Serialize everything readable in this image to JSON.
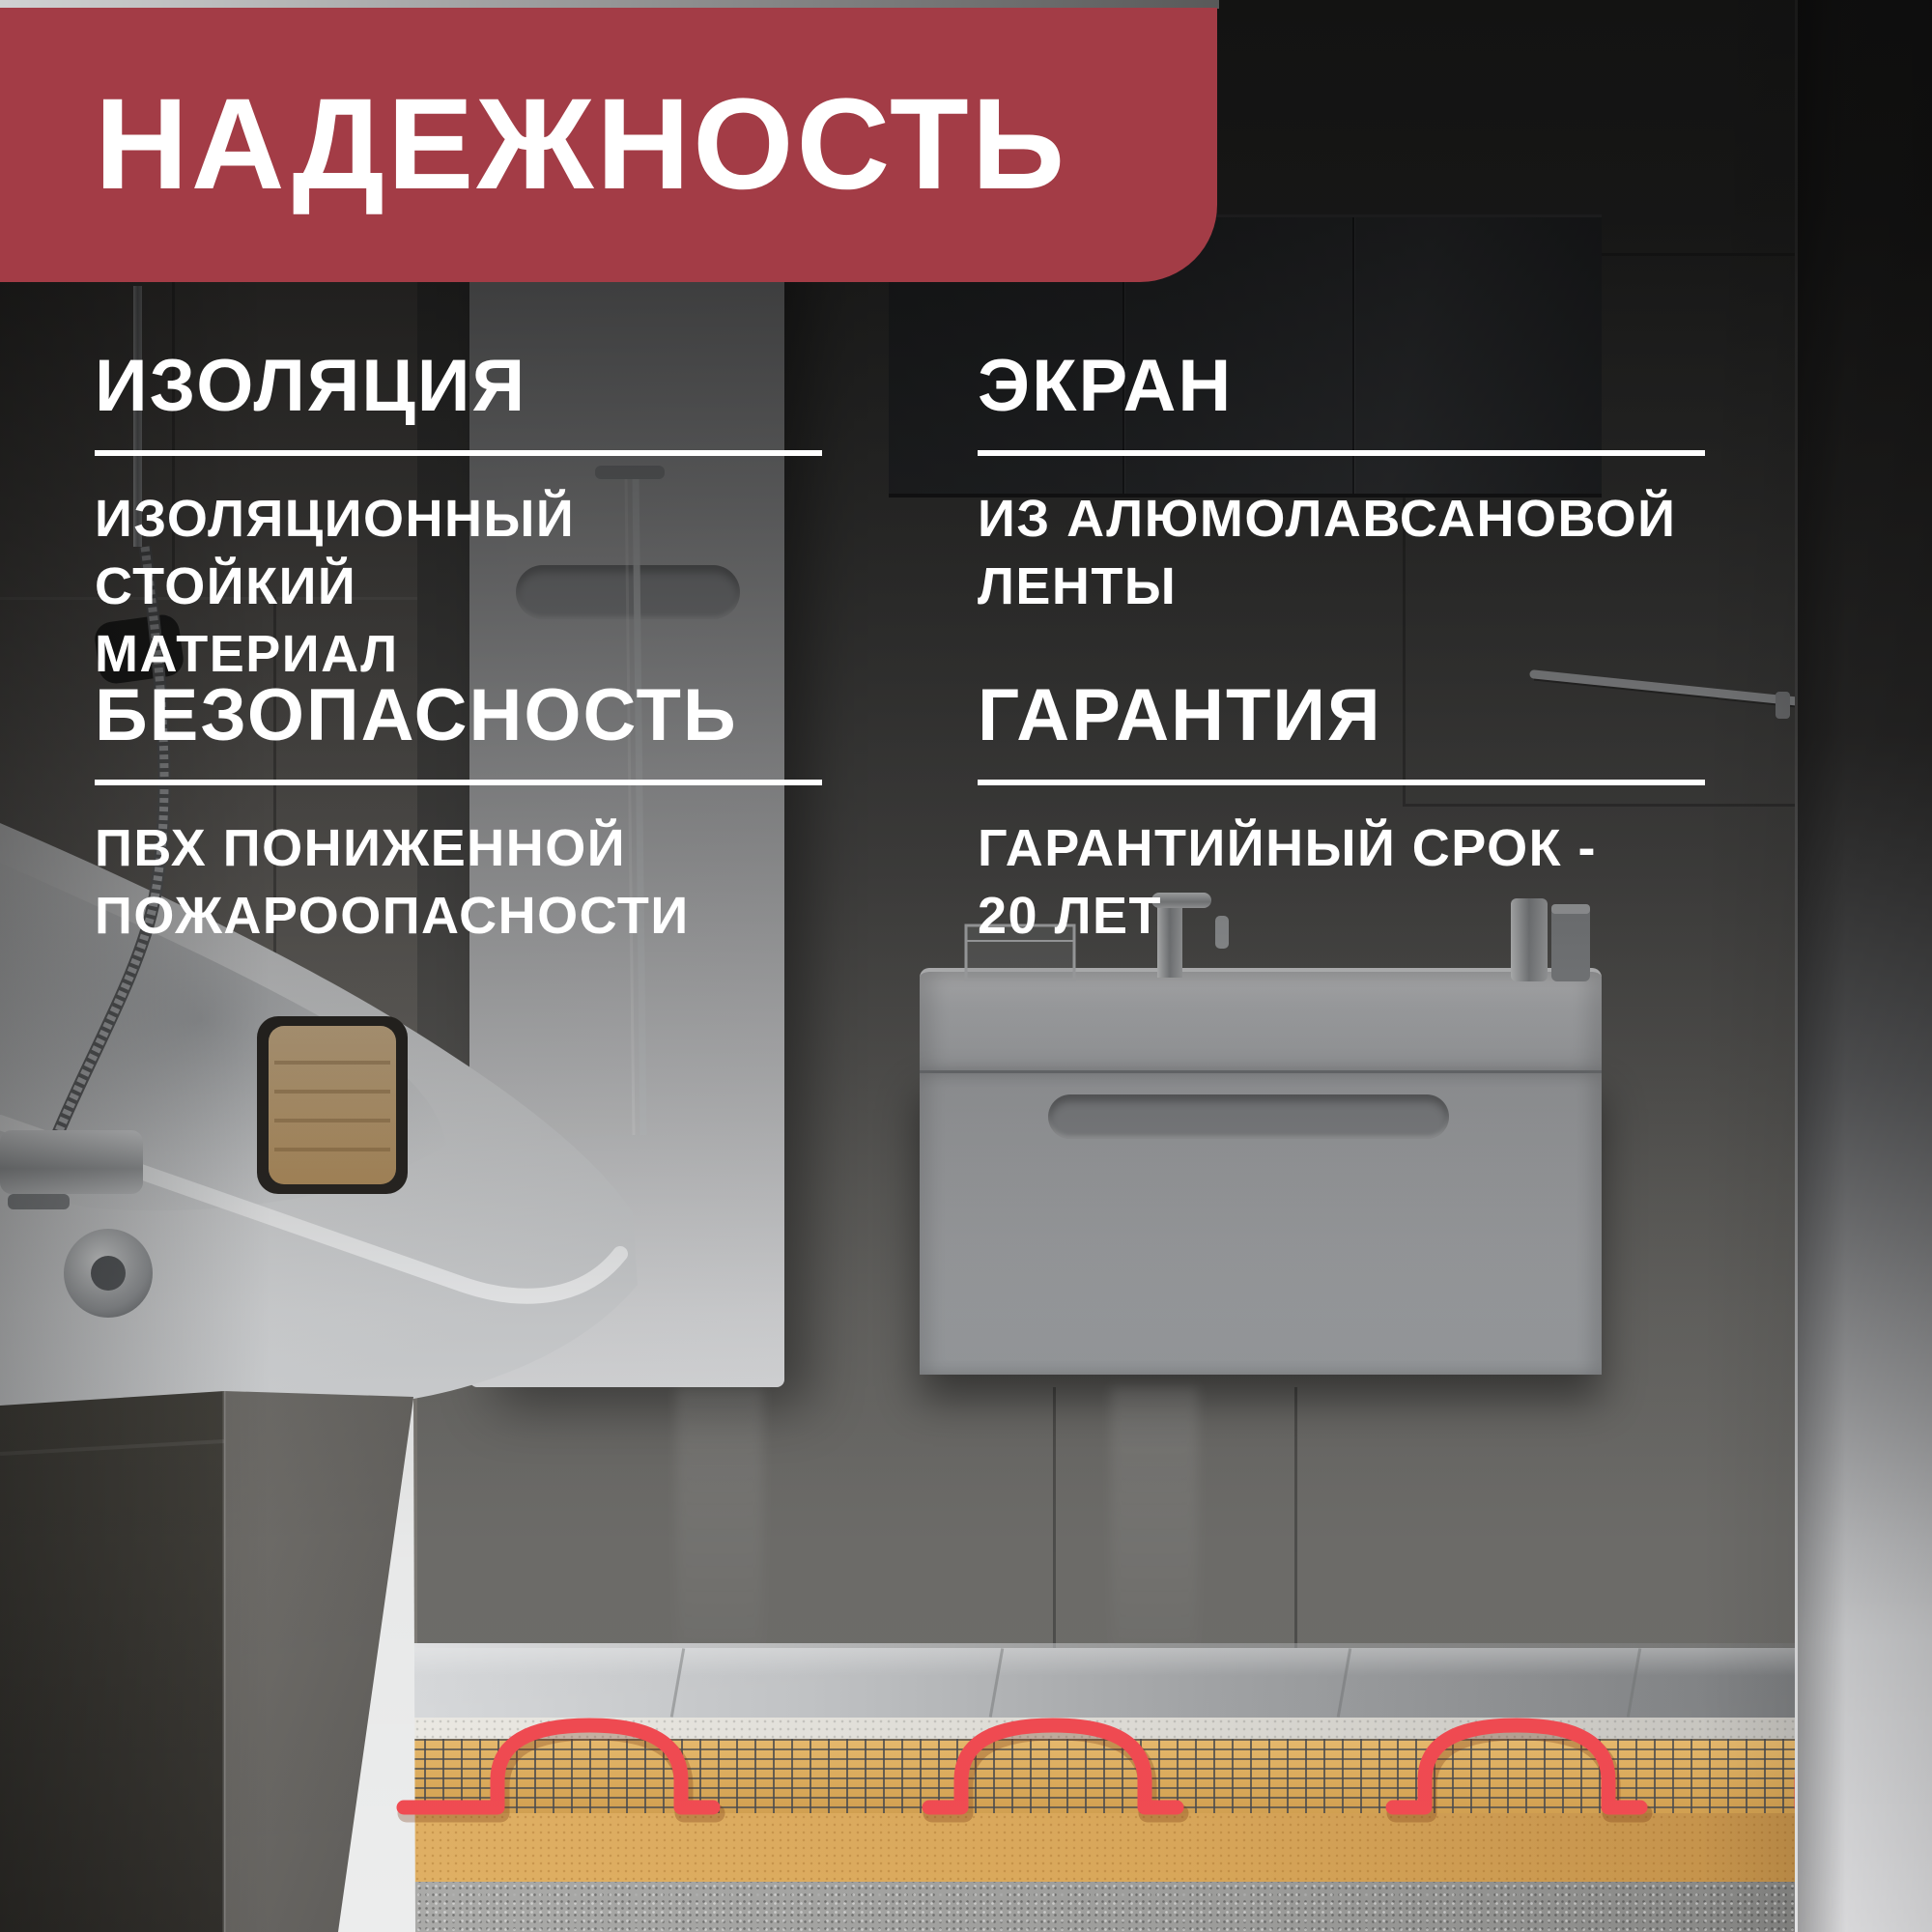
{
  "banner": {
    "title": "НАДЕЖНОСТЬ",
    "bg_color": "#A33C46",
    "text_color": "#FFFFFF"
  },
  "features": [
    {
      "id": "insulation",
      "title": "ИЗОЛЯЦИЯ",
      "description_lines": [
        "ИЗОЛЯЦИОННЫЙ СТОЙКИЙ",
        "МАТЕРИАЛ"
      ]
    },
    {
      "id": "screen",
      "title": "ЭКРАН",
      "description_lines": [
        "ИЗ АЛЮМОЛАВСАНОВОЙ",
        "ЛЕНТЫ"
      ]
    },
    {
      "id": "safety",
      "title": "БЕЗОПАСНОСТЬ",
      "description_lines": [
        "ПВХ ПОНИЖЕННОЙ",
        "ПОЖАРООПАСНОСТИ"
      ]
    },
    {
      "id": "warranty",
      "title": "ГАРАНТИЯ",
      "description_lines": [
        "ГАРАНТИЙНЫЙ СРОК -",
        "20 ЛЕТ"
      ]
    }
  ],
  "scene": {
    "divider_color": "#FFFFFF",
    "heating_cable_color": "#F14B52",
    "heating_mat_color": "#DCAB5C",
    "mesh_grid_color": "#4A4C4E",
    "concrete_color": "#9C9C9A"
  }
}
